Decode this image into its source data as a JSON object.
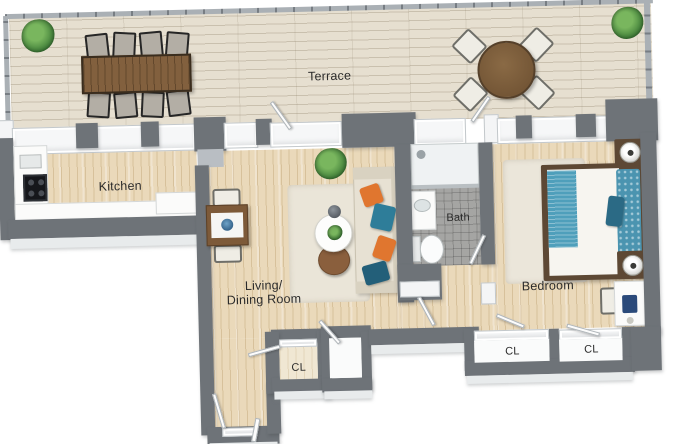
{
  "title": "3D apartment floor plan",
  "rooms": {
    "terrace": {
      "label": "Terrace"
    },
    "kitchen": {
      "label": "Kitchen"
    },
    "living_dining": {
      "label_line1": "Living/",
      "label_line2": "Dining Room"
    },
    "bath": {
      "label": "Bath"
    },
    "bedroom": {
      "label": "Bedroom"
    },
    "closet_entry": {
      "label": "CL"
    },
    "closet_left": {
      "label": "CL"
    },
    "closet_right": {
      "label": "CL"
    }
  },
  "colors": {
    "background": "#ffffff",
    "wall": "#6e7378",
    "wood_floor": "#ead9ba",
    "terrace_floor": "#e6dfd0",
    "bath_tile": "#a5a5a3",
    "accent_teal": "#4f9fbb",
    "accent_orange": "#e0762f",
    "plant_green": "#3f7d38",
    "table_brown": "#7d5a39"
  },
  "furniture_icons": [
    "outdoor-dining-table-icon",
    "outdoor-chair-icon",
    "round-table-icon",
    "plant-icon",
    "sofa-icon",
    "pillow-icon",
    "coffee-table-icon",
    "side-table-icon",
    "dining-table-icon",
    "kitchen-counter-icon",
    "stove-icon",
    "kitchen-sink-icon",
    "shower-icon",
    "vanity-sink-icon",
    "toilet-icon",
    "bed-icon",
    "nightstand-icon",
    "lamp-icon",
    "desk-icon",
    "laptop-icon",
    "desk-chair-icon",
    "rug-icon",
    "door-icon",
    "window-icon",
    "railing-icon"
  ]
}
